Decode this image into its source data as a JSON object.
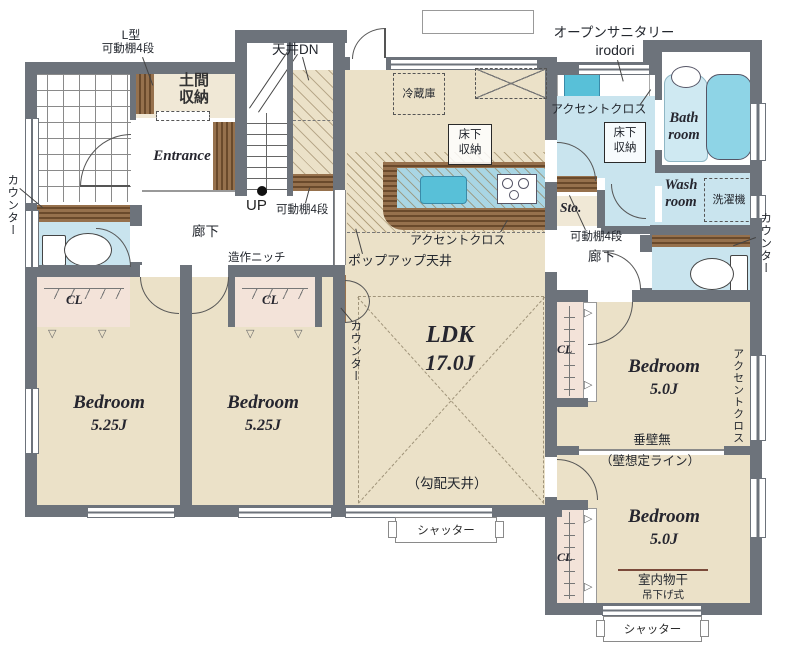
{
  "colors": {
    "wall": "#6d737b",
    "floor_beige": "#ebe1c8",
    "floor_blue": "#c9e4ee",
    "closet_pink": "#f3e3d9",
    "wood_brown": "#96714d",
    "tub_blue": "#8ed4e6",
    "sink_blue": "#58c0d8"
  },
  "rooms": {
    "ldk": {
      "name": "LDK",
      "size": "17.0J"
    },
    "bedroom1": {
      "name": "Bedroom",
      "size": "5.25J"
    },
    "bedroom2": {
      "name": "Bedroom",
      "size": "5.25J"
    },
    "bedroom3": {
      "name": "Bedroom",
      "size": "5.0J"
    },
    "bedroom4": {
      "name": "Bedroom",
      "size": "5.0J"
    },
    "bath": {
      "l1": "Bath",
      "l2": "room"
    },
    "wash": {
      "l1": "Wash",
      "l2": "room"
    },
    "entrance": {
      "name": "Entrance"
    },
    "doma": {
      "l1": "土間",
      "l2": "収納"
    },
    "storage": {
      "name": "Sto."
    },
    "hall": {
      "name": "廊下"
    },
    "closet": {
      "label": "CL"
    }
  },
  "labels": {
    "counter": "カウンター",
    "l_shelf_l1": "L型",
    "shelf4": "可動棚4段",
    "ceiling_down": "天井DN",
    "up": "UP",
    "niche": "造作ニッチ",
    "refrigerator": "冷蔵庫",
    "floor_storage_l1": "床下",
    "floor_storage_l2": "収納",
    "open_sanitary": "オープンサニタリー",
    "open_sanitary_sub": "irodori",
    "accent_cloth": "アクセントクロス",
    "washer": "洗濯機",
    "popup_ceiling": "ポップアップ天井",
    "slope_ceiling": "（勾配天井）",
    "no_hanging_wall": "垂壁無",
    "assumed_wall": "（壁想定ライン）",
    "indoor_drying": "室内物干",
    "hanging_type": "吊下げ式",
    "shutter": "シャッター"
  }
}
